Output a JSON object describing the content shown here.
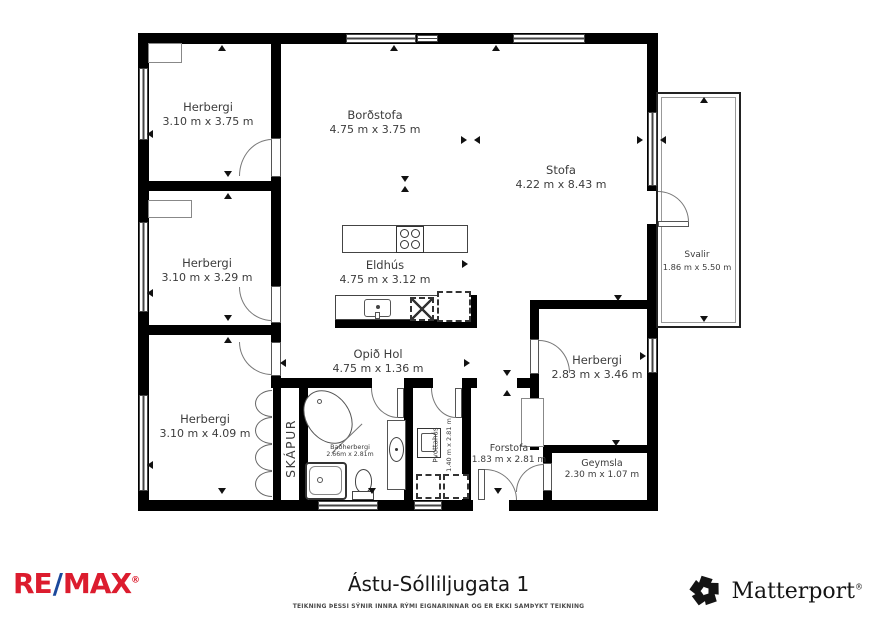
{
  "plan": {
    "rooms": {
      "bedroom_top_left": {
        "name": "Herbergi",
        "dims": "3.10 m x 3.75 m"
      },
      "dining": {
        "name": "Borðstofa",
        "dims": "4.75 m x 3.75 m"
      },
      "living": {
        "name": "Stofa",
        "dims": "4.22 m x 8.43 m"
      },
      "bedroom_mid_left": {
        "name": "Herbergi",
        "dims": "3.10 m x 3.29 m"
      },
      "kitchen": {
        "name": "Eldhús",
        "dims": "4.75 m x 3.12 m"
      },
      "balcony": {
        "name": "Svalir",
        "dims": "1.86 m x 5.50 m"
      },
      "hall": {
        "name": "Opið Hol",
        "dims": "4.75 m x 1.36 m"
      },
      "bedroom_right": {
        "name": "Herbergi",
        "dims": "2.83 m x 3.46 m"
      },
      "bedroom_bottom_left": {
        "name": "Herbergi",
        "dims": "3.10 m x 4.09 m"
      },
      "closet": {
        "name": "SKÁPUR"
      },
      "bathroom": {
        "name": "Baðherbergi",
        "dims": "2.66m x 2.81m"
      },
      "laundry": {
        "name": "Þvottahús",
        "dims": "1.40 m x 2.81 m"
      },
      "entry": {
        "name": "Forstofa",
        "dims": "1.83 m x 2.81 m"
      },
      "storage": {
        "name": "Geymsla",
        "dims": "2.30 m x 1.07 m"
      }
    },
    "wall_color": "#000000"
  },
  "footer": {
    "title": "Ástu-Sólliljugata 1",
    "disclaimer": "TEIKNING ÞESSI SÝNIR INNRA RÝMI EIGNARINNAR OG ER EKKI SAMÞYKT TEIKNING",
    "remax": {
      "part1": "RE",
      "slash": "/",
      "part2": "MAX",
      "reg": "®",
      "red": "#DC1C2E",
      "blue": "#1B489C"
    },
    "matterport": {
      "label": "Matterport",
      "reg": "®",
      "color": "#141414"
    }
  }
}
